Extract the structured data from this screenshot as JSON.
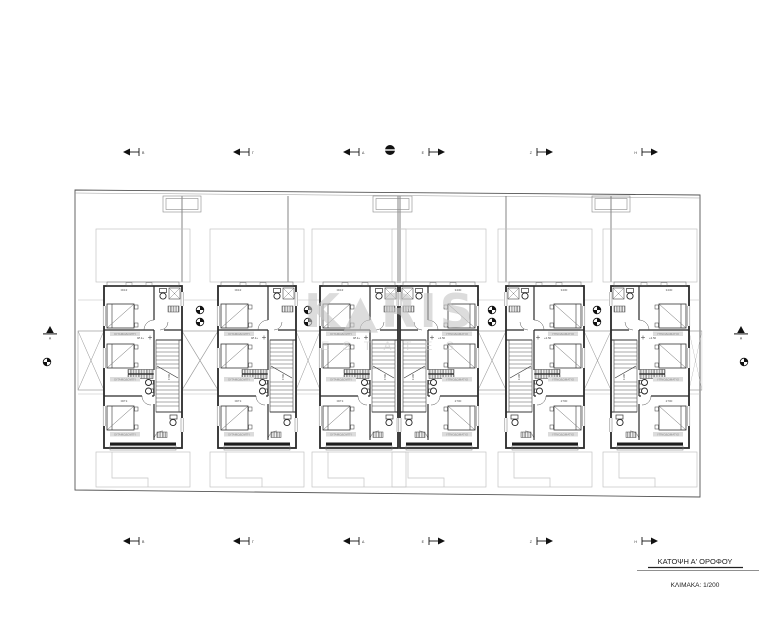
{
  "title_block": {
    "title": "ΚΑΤΟΨΗ Α' ΟΡΟΦΟΥ",
    "scale": "ΚΛΙΜΑΚΑ: 1/200"
  },
  "watermark": {
    "text": "K▲RIS",
    "subtext": "E S T A T E S"
  },
  "section_markers": {
    "top": [
      "Β",
      "Γ",
      "Δ",
      "Ε",
      "Ζ",
      "Η"
    ],
    "bottom": [
      "Β",
      "Γ",
      "Δ",
      "Ε",
      "Ζ",
      "Η"
    ],
    "left_edge": "Α",
    "right_edge": "Α"
  },
  "unit_plan": {
    "bedroom_label": "ΥΠΝΟΔΩΜΑΤΙΟ",
    "dim_top": "3430",
    "dim_stairs": "1100",
    "dim_bottom": "2700",
    "level": "+2.50"
  },
  "colors": {
    "line_dark": "#262626",
    "line_mid": "#6e6e6e",
    "line_light": "#c4c4c4",
    "label_strip": "#dcdcdc",
    "watermark_gray": "#c6c6c6"
  }
}
